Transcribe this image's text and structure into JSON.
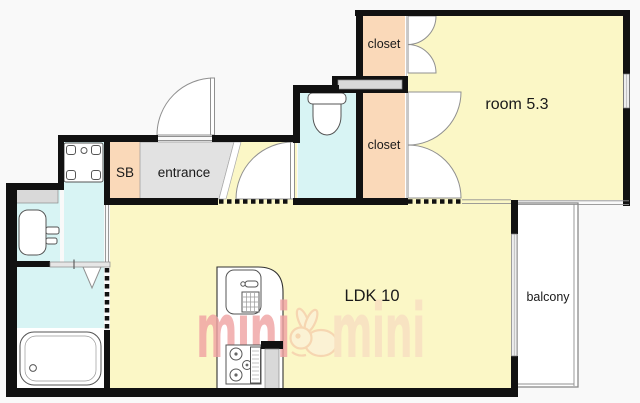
{
  "plan": {
    "rooms": {
      "closet_top": "closet",
      "closet_bottom": "closet",
      "western_room": "room 5.3",
      "shoe_box": "SB",
      "entrance": "entrance",
      "ldk": "LDK 10",
      "balcony": "balcony"
    },
    "watermark": {
      "word_left": "mini",
      "word_right": "mini",
      "mascot": "rabbit"
    }
  },
  "colors": {
    "bg": "#F9F9F9",
    "wall": "#111111",
    "yellow": "#FBF7C6",
    "peach": "#FAD9B9",
    "cyan": "#D8F4F4",
    "egray": "#E2E2E2",
    "gray2": "#D9D9D9",
    "line": "#909090",
    "fixture": "#555555",
    "text": "#1A1A1A",
    "pink": "#F0A2A2",
    "cream": "#F8DFC2",
    "rabbit": "#F5CEAC",
    "rabbitfill": "#FBF2D8"
  }
}
